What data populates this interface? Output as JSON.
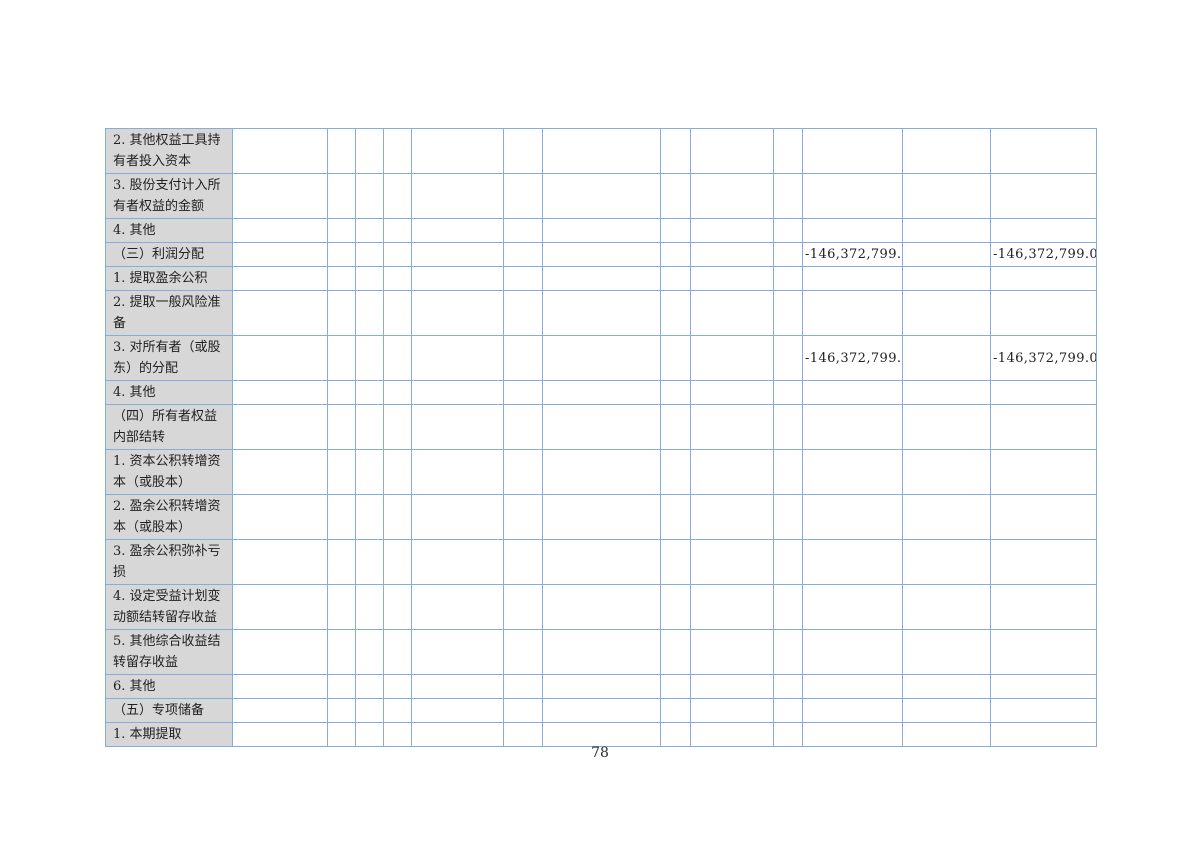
{
  "page": {
    "number": "78"
  },
  "colors": {
    "border": "#86add9",
    "label_bg": "#d7d7d7",
    "text": "#212121",
    "page_bg": "#ffffff"
  },
  "table": {
    "data_columns": 13,
    "rows": [
      {
        "label": "2. 其他权益工具持有者投入资本",
        "values": {}
      },
      {
        "label": "3. 股份支付计入所有者权益的金额",
        "values": {}
      },
      {
        "label": "4. 其他",
        "values": {}
      },
      {
        "label": "（三）利润分配",
        "values": {
          "10": "-146,372,799.02",
          "12": "-146,372,799.02"
        }
      },
      {
        "label": "1. 提取盈余公积",
        "values": {}
      },
      {
        "label": "2. 提取一般风险准备",
        "values": {}
      },
      {
        "label": "3. 对所有者（或股东）的分配",
        "values": {
          "10": "-146,372,799.02",
          "12": "-146,372,799.02"
        }
      },
      {
        "label": "4. 其他",
        "values": {}
      },
      {
        "label": "（四）所有者权益内部结转",
        "values": {}
      },
      {
        "label": "1. 资本公积转增资本（或股本）",
        "values": {}
      },
      {
        "label": "2. 盈余公积转增资本（或股本）",
        "values": {}
      },
      {
        "label": "3. 盈余公积弥补亏损",
        "values": {}
      },
      {
        "label": "4. 设定受益计划变动额结转留存收益",
        "values": {}
      },
      {
        "label": "5. 其他综合收益结转留存收益",
        "values": {}
      },
      {
        "label": "6. 其他",
        "values": {}
      },
      {
        "label": "（五）专项储备",
        "values": {}
      },
      {
        "label": "1. 本期提取",
        "values": {}
      }
    ]
  }
}
